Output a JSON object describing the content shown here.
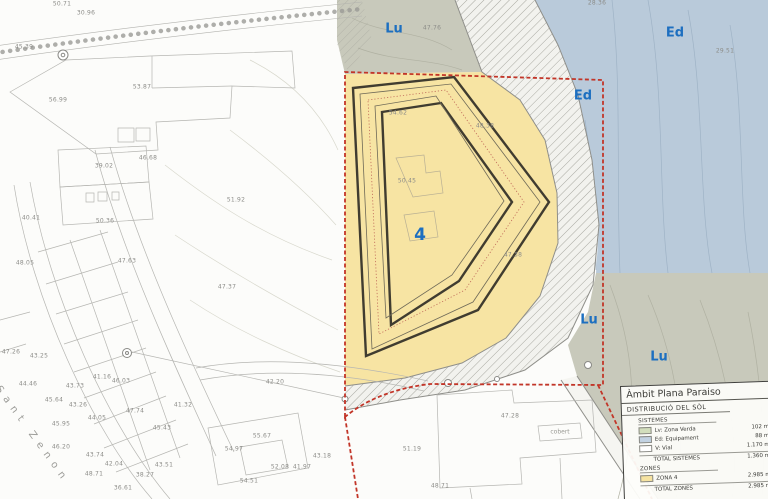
{
  "map": {
    "zone_labels": [
      {
        "text": "Lu",
        "x": 394,
        "y": 29,
        "size": 13
      },
      {
        "text": "Ed",
        "x": 675,
        "y": 33,
        "size": 13
      },
      {
        "text": "Ed",
        "x": 583,
        "y": 96,
        "size": 13
      },
      {
        "text": "4",
        "x": 420,
        "y": 235,
        "size": 17
      },
      {
        "text": "Lu",
        "x": 589,
        "y": 320,
        "size": 13
      },
      {
        "text": "Lu",
        "x": 659,
        "y": 357,
        "size": 13
      }
    ],
    "street_label": {
      "text": "Sant Zenon"
    },
    "misc_labels": [
      {
        "text": "cobert",
        "x": 560,
        "y": 432
      }
    ],
    "elevation_labels": [
      {
        "x": 62,
        "y": 4,
        "t": "50.71"
      },
      {
        "x": 86,
        "y": 13,
        "t": "30.96"
      },
      {
        "x": 24,
        "y": 47,
        "t": "45.39"
      },
      {
        "x": 58,
        "y": 100,
        "t": "56.99"
      },
      {
        "x": 142,
        "y": 87,
        "t": "53.87"
      },
      {
        "x": 148,
        "y": 158,
        "t": "46.68"
      },
      {
        "x": 104,
        "y": 166,
        "t": "39.02"
      },
      {
        "x": 31,
        "y": 218,
        "t": "40.41"
      },
      {
        "x": 105,
        "y": 221,
        "t": "50.36"
      },
      {
        "x": 25,
        "y": 263,
        "t": "48.05"
      },
      {
        "x": 127,
        "y": 261,
        "t": "47.63"
      },
      {
        "x": 236,
        "y": 200,
        "t": "51.92"
      },
      {
        "x": 227,
        "y": 287,
        "t": "47.37"
      },
      {
        "x": 432,
        "y": 28,
        "t": "47.76"
      },
      {
        "x": 597,
        "y": 3,
        "t": "28.36"
      },
      {
        "x": 725,
        "y": 51,
        "t": "29.51"
      },
      {
        "x": 398,
        "y": 113,
        "t": "54.62"
      },
      {
        "x": 485,
        "y": 126,
        "t": "48.38"
      },
      {
        "x": 407,
        "y": 181,
        "t": "50.45"
      },
      {
        "x": 513,
        "y": 255,
        "t": "47.38"
      },
      {
        "x": 11,
        "y": 352,
        "t": "47.26"
      },
      {
        "x": 39,
        "y": 356,
        "t": "43.25"
      },
      {
        "x": 28,
        "y": 384,
        "t": "44.46"
      },
      {
        "x": 75,
        "y": 386,
        "t": "43.73"
      },
      {
        "x": 54,
        "y": 400,
        "t": "45.64"
      },
      {
        "x": 78,
        "y": 405,
        "t": "43.26"
      },
      {
        "x": 102,
        "y": 377,
        "t": "41.16"
      },
      {
        "x": 121,
        "y": 381,
        "t": "46.03"
      },
      {
        "x": 61,
        "y": 424,
        "t": "45.95"
      },
      {
        "x": 97,
        "y": 418,
        "t": "44.05"
      },
      {
        "x": 135,
        "y": 411,
        "t": "47.74"
      },
      {
        "x": 162,
        "y": 428,
        "t": "45.43"
      },
      {
        "x": 183,
        "y": 405,
        "t": "41.32"
      },
      {
        "x": 61,
        "y": 447,
        "t": "46.20"
      },
      {
        "x": 95,
        "y": 455,
        "t": "43.74"
      },
      {
        "x": 94,
        "y": 474,
        "t": "48.71"
      },
      {
        "x": 114,
        "y": 464,
        "t": "42.04"
      },
      {
        "x": 164,
        "y": 465,
        "t": "43.51"
      },
      {
        "x": 123,
        "y": 488,
        "t": "36.61"
      },
      {
        "x": 145,
        "y": 475,
        "t": "38.27"
      },
      {
        "x": 275,
        "y": 382,
        "t": "42.20"
      },
      {
        "x": 262,
        "y": 436,
        "t": "55.67"
      },
      {
        "x": 234,
        "y": 449,
        "t": "54.97"
      },
      {
        "x": 322,
        "y": 456,
        "t": "43.18"
      },
      {
        "x": 280,
        "y": 467,
        "t": "52.08"
      },
      {
        "x": 302,
        "y": 467,
        "t": "41.97"
      },
      {
        "x": 249,
        "y": 481,
        "t": "54.51"
      },
      {
        "x": 412,
        "y": 449,
        "t": "51.19"
      },
      {
        "x": 510,
        "y": 416,
        "t": "47.28"
      },
      {
        "x": 440,
        "y": 486,
        "t": "48.71"
      }
    ]
  },
  "legend": {
    "title": "Àmbit Plana Paraiso",
    "subtitle": "DISTRIBUCIÓ DEL SÒL",
    "sections": [
      {
        "name": "SISTEMES",
        "rows": [
          {
            "swatch": "#d2debc",
            "label": "Lv: Zona Verda",
            "value": "102 m2"
          },
          {
            "swatch": "#c2d2e2",
            "label": "Ed: Equipament",
            "value": "88 m2"
          },
          {
            "swatch": "#ffffff",
            "label": "V: Vial",
            "value": "1.170 m2"
          }
        ],
        "total": {
          "label": "TOTAL SISTEMES",
          "value": "1.360 m2"
        }
      },
      {
        "name": "ZONES",
        "rows": [
          {
            "swatch": "#f6e3a1",
            "label": "ZONA 4",
            "value": "2.985 m2"
          }
        ],
        "total": {
          "label": "TOTAL ZONES",
          "value": "2.985 m2"
        }
      }
    ]
  },
  "colors": {
    "zone4_fill": "#f7e4a3",
    "equipament_fill": "#b9cada",
    "zona_verda_fill": "#c8c9bb",
    "boundary_red": "#c23528",
    "zone_label_blue": "#1d6fc0"
  }
}
